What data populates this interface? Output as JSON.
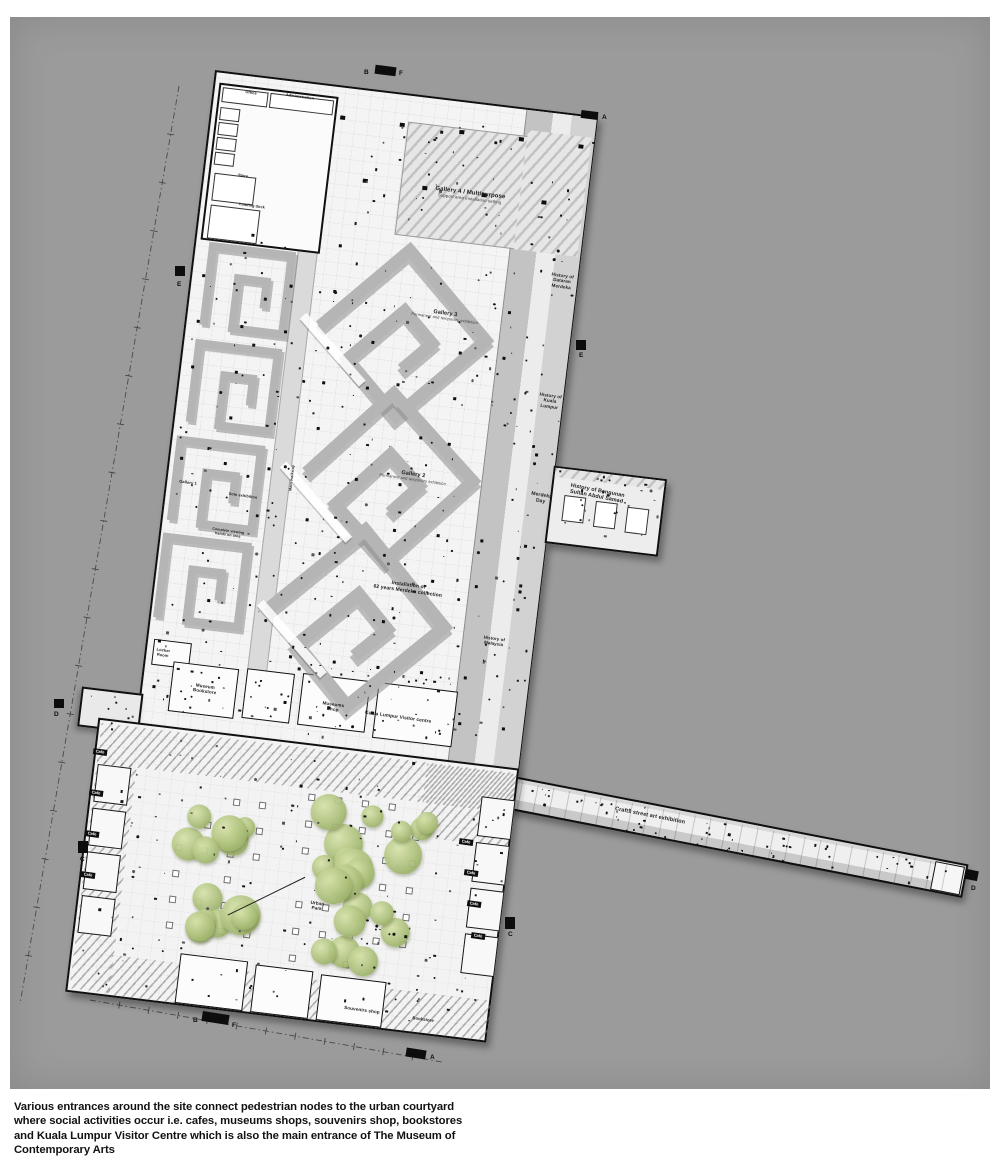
{
  "colors": {
    "artboard": "#9b9b9b",
    "ink": "#101010",
    "floor": "#f4f4f4",
    "tree": "#aabe79",
    "wall": "#b5b5b5"
  },
  "caption": {
    "lines": [
      "Various entrances around the site connect pedestrian nodes to the urban courtyard",
      "where social activities occur i.e. cafes, museums shops, souvenirs shop, bookstores",
      "and Kuala Lumpur Visitor Centre which is also the main entrance of The Museum of",
      "Contemporary Arts"
    ]
  },
  "plan_labels": [
    {
      "text": "Gallery 4 / Multipurpose",
      "sub": "Support area installation setting",
      "x": 470,
      "y": 196,
      "rot": 7,
      "size": 6,
      "weight": 700
    },
    {
      "text": "Gallery 3",
      "sub": "Permanent and temporary exhibition",
      "x": 445,
      "y": 316,
      "rot": 8,
      "size": 5.5,
      "weight": 700
    },
    {
      "text": "Gallery 2",
      "sub": "Permanent and temporary exhibition",
      "x": 413,
      "y": 477,
      "rot": 8,
      "size": 5.5,
      "weight": 700
    },
    {
      "text": "Installation of\n62 years Merdeka collection",
      "x": 408,
      "y": 589,
      "rot": 8,
      "size": 5,
      "weight": 700
    },
    {
      "text": "Merdeka\nDay",
      "x": 541,
      "y": 499,
      "rot": 10,
      "size": 5,
      "weight": 600
    },
    {
      "text": "History of Bangunan\nSultan Abdul Samad",
      "x": 597,
      "y": 494,
      "rot": 11,
      "size": 5.4,
      "weight": 700
    },
    {
      "text": "History of\nDataran\nMerdeka",
      "x": 562,
      "y": 281,
      "rot": 8,
      "size": 4.6,
      "weight": 600
    },
    {
      "text": "History of\nKuala\nLumpur",
      "x": 550,
      "y": 401,
      "rot": 8,
      "size": 4.6,
      "weight": 600
    },
    {
      "text": "History of\nMalaysia",
      "x": 494,
      "y": 641,
      "rot": 8,
      "size": 4.4,
      "weight": 600
    },
    {
      "text": "Museum\nBookstore",
      "x": 205,
      "y": 689,
      "rot": 8,
      "size": 4.6,
      "weight": 600
    },
    {
      "text": "Locker\nRoom",
      "x": 163,
      "y": 653,
      "rot": 8,
      "size": 4,
      "weight": 600
    },
    {
      "text": "Museums\nShop",
      "x": 333,
      "y": 707,
      "rot": 8,
      "size": 4.6,
      "weight": 600
    },
    {
      "text": "Kuala Lumpur Visitor centre",
      "x": 398,
      "y": 718,
      "rot": 8,
      "size": 4.8,
      "weight": 700
    },
    {
      "text": "Crafts street art exhibition",
      "x": 650,
      "y": 816,
      "rot": 11,
      "size": 5.5,
      "weight": 700
    },
    {
      "text": "Urban\nPark",
      "x": 317,
      "y": 906,
      "rot": 8,
      "size": 4.6,
      "weight": 600
    },
    {
      "text": "Souvenirs shop",
      "x": 362,
      "y": 1010,
      "rot": 8,
      "size": 4.6,
      "weight": 600
    },
    {
      "text": "Bookstore",
      "x": 423,
      "y": 1020,
      "rot": 8,
      "size": 4.2,
      "weight": 600
    },
    {
      "text": "Office",
      "x": 251,
      "y": 93,
      "rot": 8,
      "size": 3.8,
      "weight": 600
    },
    {
      "text": "Administration",
      "x": 300,
      "y": 97,
      "rot": 8,
      "size": 3.8,
      "weight": 600
    },
    {
      "text": "Store",
      "x": 243,
      "y": 176,
      "rot": 8,
      "size": 3.8,
      "weight": 600
    },
    {
      "text": "Loading dock",
      "x": 252,
      "y": 206,
      "rot": 8,
      "size": 3.8,
      "weight": 600
    },
    {
      "text": "Gallery 1",
      "x": 188,
      "y": 483,
      "rot": 8,
      "size": 4,
      "weight": 600
    },
    {
      "text": "Solo exhibition",
      "x": 243,
      "y": 496,
      "rot": 8,
      "size": 3.8,
      "weight": 600
    },
    {
      "text": "Main walkway",
      "x": 292,
      "y": 478,
      "rot": -83,
      "size": 3.8,
      "weight": 600
    },
    {
      "text": "Complete viewing\nhands on area",
      "x": 228,
      "y": 533,
      "rot": 8,
      "size": 3.6,
      "weight": 600
    }
  ],
  "cafe_chips": [
    {
      "text": "Cafe",
      "x": 466,
      "y": 842
    },
    {
      "text": "Cafe",
      "x": 471,
      "y": 873
    },
    {
      "text": "Cafe",
      "x": 474,
      "y": 904
    },
    {
      "text": "Cafe",
      "x": 478,
      "y": 936
    },
    {
      "text": "Cafe",
      "x": 100,
      "y": 752
    },
    {
      "text": "Cafe",
      "x": 96,
      "y": 793
    },
    {
      "text": "Cafe",
      "x": 92,
      "y": 834
    },
    {
      "text": "Cafe",
      "x": 88,
      "y": 875
    }
  ],
  "section_markers": {
    "letters": [
      {
        "ch": "B",
        "x": 364,
        "y": 69
      },
      {
        "ch": "F",
        "x": 399,
        "y": 70
      },
      {
        "ch": "A",
        "x": 602,
        "y": 114
      },
      {
        "ch": "E",
        "x": 177,
        "y": 281
      },
      {
        "ch": "E",
        "x": 579,
        "y": 352
      },
      {
        "ch": "D",
        "x": 54,
        "y": 711
      },
      {
        "ch": "D",
        "x": 971,
        "y": 885
      },
      {
        "ch": "C",
        "x": 80,
        "y": 856
      },
      {
        "ch": "C",
        "x": 508,
        "y": 931
      },
      {
        "ch": "B",
        "x": 193,
        "y": 1017
      },
      {
        "ch": "F",
        "x": 232,
        "y": 1022
      },
      {
        "ch": "A",
        "x": 430,
        "y": 1054
      }
    ],
    "bars": [
      [
        375,
        66,
        21,
        9,
        7
      ],
      [
        581,
        111,
        17,
        8,
        7
      ],
      [
        175,
        266,
        10,
        10,
        0
      ],
      [
        576,
        340,
        10,
        10,
        0
      ],
      [
        54,
        699,
        10,
        9,
        0
      ],
      [
        965,
        870,
        13,
        10,
        11
      ],
      [
        78,
        841,
        10,
        12,
        0
      ],
      [
        505,
        917,
        10,
        12,
        0
      ],
      [
        202,
        1013,
        27,
        10,
        9
      ],
      [
        406,
        1049,
        20,
        9,
        9
      ]
    ]
  }
}
